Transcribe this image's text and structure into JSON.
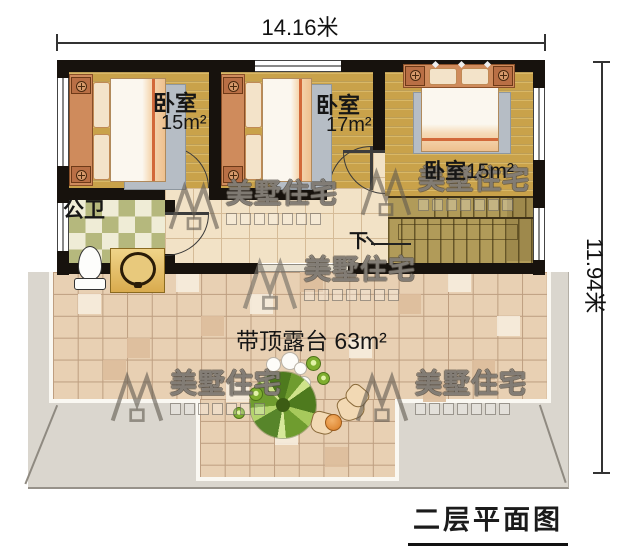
{
  "title": "二层平面图",
  "dimensions": {
    "top": "14.16米",
    "right": "11.94米"
  },
  "rooms": {
    "bedroom1": {
      "name": "卧室",
      "area": "15m²"
    },
    "bedroom2": {
      "name": "卧室",
      "area": "17m²"
    },
    "bedroom3": {
      "name": "卧室",
      "area": "15m²"
    },
    "bathroom": {
      "label": "公卫"
    },
    "stairs": {
      "down_label": "下"
    },
    "terrace": {
      "name": "带顶露台",
      "area": "63m²"
    }
  },
  "watermark": {
    "brand": "美墅住宅"
  },
  "colors": {
    "wall": "#17120d",
    "wood_floor": "#c9a24a",
    "hall_tile": "#f2e2c6",
    "terrace_tile": "#e8d0b3",
    "stair": "#b19b59",
    "roof_eave": "#dad6ce",
    "checker_green": "#b5b87d",
    "checker_cream": "#efecd6"
  }
}
